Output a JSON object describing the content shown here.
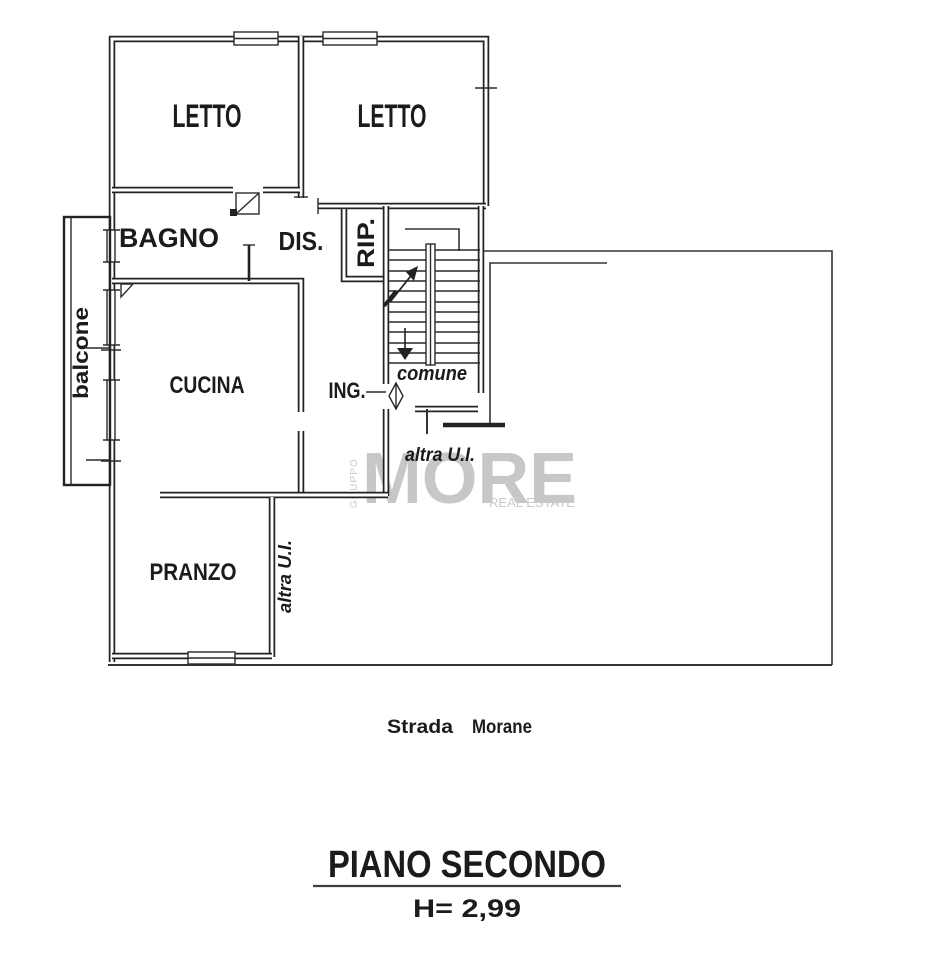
{
  "rooms": {
    "letto_left": "LETTO",
    "letto_right": "LETTO",
    "bagno": "BAGNO",
    "dis": "DIS.",
    "rip": "RIP.",
    "cucina": "CUCINA",
    "ing": "ING.",
    "comune": "comune",
    "altra_ui_stair": "altra U.I.",
    "altra_ui_pranzo": "altra U.I.",
    "pranzo": "PRANZO",
    "balcone": "balcone"
  },
  "street": {
    "word1": "Strada",
    "word2": "Morane"
  },
  "caption": {
    "floor": "PIANO SECONDO",
    "height": "H= 2,99"
  },
  "watermark": {
    "vertical": "GRUPPO",
    "brand": "MORE",
    "tagline": "REAL ESTATE"
  },
  "colors": {
    "ink": "#1b1b1b",
    "wall": "#222222",
    "watermark_gray": "#c7c7c7",
    "paper": "#ffffff"
  }
}
